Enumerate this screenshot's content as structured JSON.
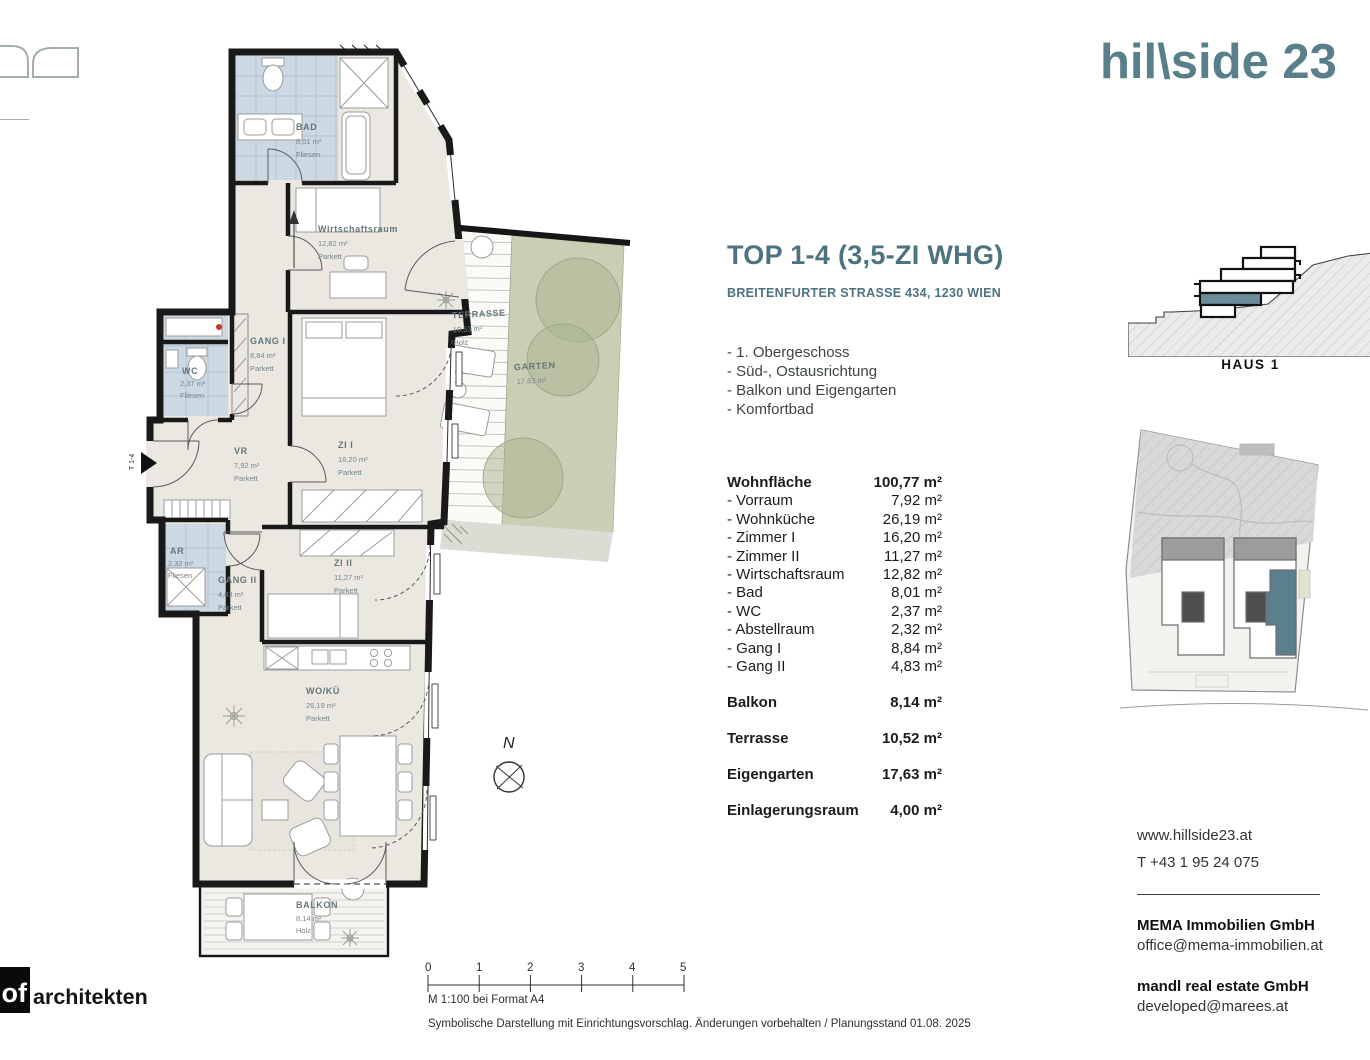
{
  "brand": {
    "logo_text": "hil\\side 23"
  },
  "header": {
    "title": "TOP 1-4 (3,5-ZI WHG)",
    "address": "BREITENFURTER STRASSE 434, 1230 WIEN"
  },
  "features": [
    "- 1. Obergeschoss",
    "- Süd-, Ostausrichtung",
    "- Balkon und Eigengarten",
    "- Komfortbad"
  ],
  "areas": {
    "main": {
      "label": "Wohnfläche",
      "value": "100,77 m²"
    },
    "rooms": [
      {
        "label": "- Vorraum",
        "value": "7,92 m²"
      },
      {
        "label": "- Wohnküche",
        "value": "26,19 m²"
      },
      {
        "label": "- Zimmer I",
        "value": "16,20 m²"
      },
      {
        "label": "- Zimmer II",
        "value": "11,27 m²"
      },
      {
        "label": "- Wirtschaftsraum",
        "value": "12,82 m²"
      },
      {
        "label": "- Bad",
        "value": "8,01 m²"
      },
      {
        "label": "- WC",
        "value": "2,37 m²"
      },
      {
        "label": "- Abstellraum",
        "value": "2,32 m²"
      },
      {
        "label": "- Gang I",
        "value": "8,84 m²"
      },
      {
        "label": "- Gang II",
        "value": "4,83 m²"
      }
    ],
    "extras": [
      {
        "label": "Balkon",
        "value": "8,14 m²"
      },
      {
        "label": "Terrasse",
        "value": "10,52 m²"
      },
      {
        "label": "Eigengarten",
        "value": "17,63 m²"
      },
      {
        "label": "Einlagerungsraum",
        "value": "4,00 m²"
      }
    ]
  },
  "plan": {
    "rooms": {
      "bad": {
        "name": "BAD",
        "area": "8,01 m²",
        "floor": "Fliesen"
      },
      "wirtschaftsraum": {
        "name": "Wirtschaftsraum",
        "area": "12,82 m²",
        "floor": "Parkett"
      },
      "gang1": {
        "name": "GANG I",
        "area": "8,84 m²",
        "floor": "Parkett"
      },
      "wc": {
        "name": "WC",
        "area": "2,37 m²",
        "floor": "Fliesen"
      },
      "vr": {
        "name": "VR",
        "area": "7,92 m²",
        "floor": "Parkett"
      },
      "zi1": {
        "name": "ZI I",
        "area": "16,20 m²",
        "floor": "Parkett"
      },
      "ar": {
        "name": "AR",
        "area": "2,32 m²",
        "floor": "Fliesen"
      },
      "gang2": {
        "name": "GANG II",
        "area": "4,83 m²",
        "floor": "Parkett"
      },
      "zi2": {
        "name": "ZI II",
        "area": "11,27 m²",
        "floor": "Parkett"
      },
      "wokue": {
        "name": "WO/KÜ",
        "area": "26,19 m²",
        "floor": "Parkett"
      },
      "balkon": {
        "name": "BALKON",
        "area": "8,14 m²",
        "floor": "Holz"
      },
      "terrasse": {
        "name": "TERRASSE",
        "area": "10,53 m²",
        "floor": "Holz"
      },
      "garten": {
        "name": "GARTEN",
        "area": "17,63 m²"
      }
    },
    "compass": "N",
    "entrance_label": "T 1-4"
  },
  "right_column": {
    "haus_label": "HAUS 1",
    "website": "www.hillside23.at",
    "phone": "T +43 1 95 24 075",
    "companies": [
      {
        "name": "MEMA Immobilien GmbH",
        "email": "office@mema-immobilien.at"
      },
      {
        "name": "mandl real estate GmbH",
        "email": "developed@marees.at"
      }
    ]
  },
  "footer": {
    "scale_ticks": [
      "0",
      "1",
      "2",
      "3",
      "4",
      "5"
    ],
    "scale_note": "M 1:100 bei Format A4",
    "disclaimer": "Symbolische Darstellung mit Einrichtungsvorschlag. Änderungen vorbehalten / Planungsstand 01.08. 2025",
    "architect_logo": "of",
    "architect_name": "architekten"
  }
}
